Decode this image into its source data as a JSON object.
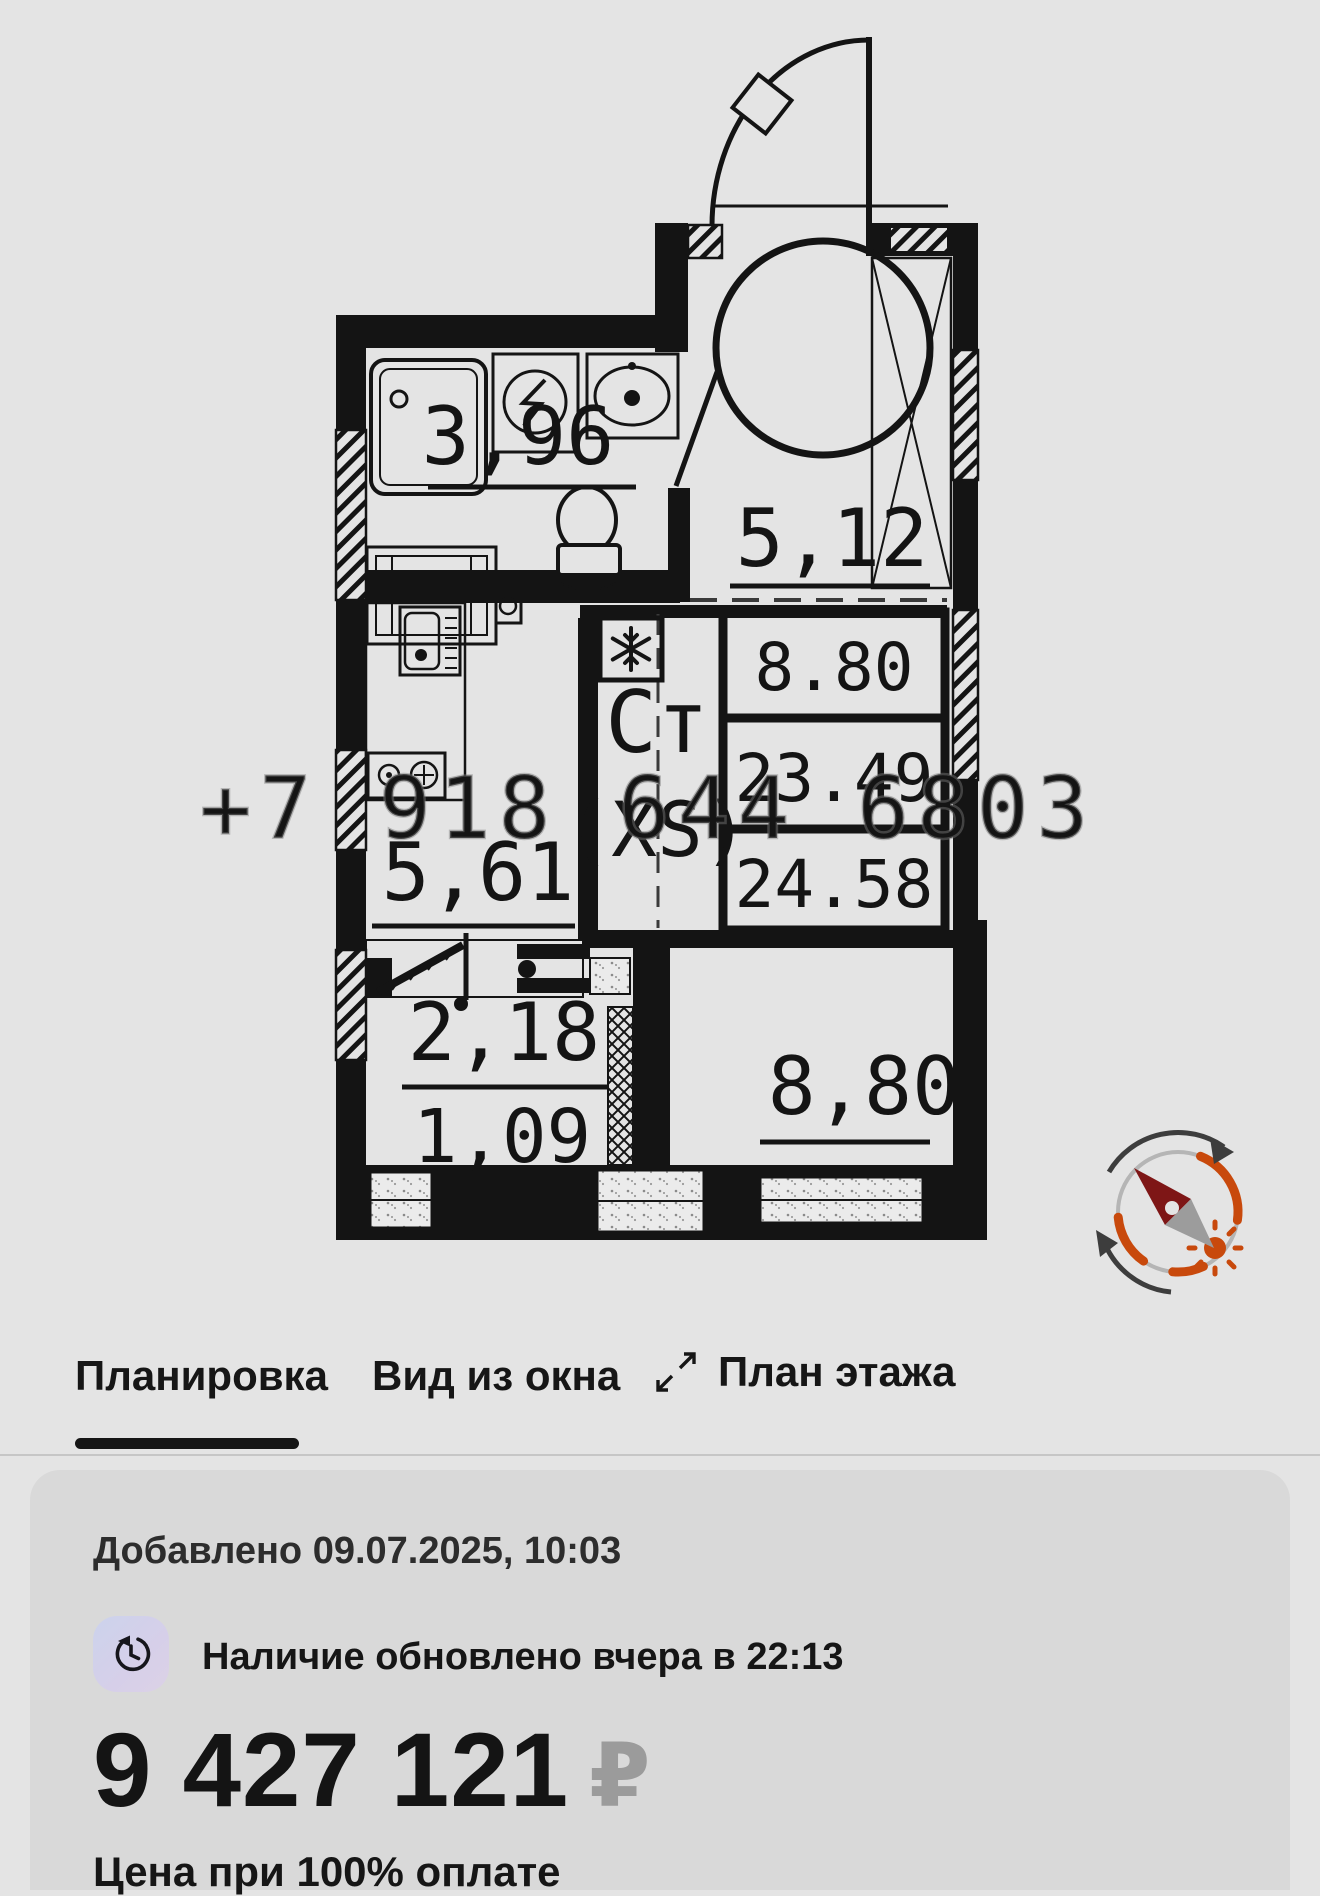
{
  "watermark": "+7 918 644 6803",
  "plan": {
    "rooms": {
      "bathroom": "3,96",
      "hallway": "5,12",
      "kitchen": "5,61",
      "corridor": "2,18",
      "closet": "1,09",
      "bedroom": "8,80"
    },
    "area_table": {
      "rows": [
        "8.80",
        "23.49",
        "24.58"
      ]
    },
    "unit_type": "Ст",
    "unit_size": "(XS)"
  },
  "tabs": {
    "items": [
      {
        "label": "Планировка",
        "active": true
      },
      {
        "label": "Вид из окна",
        "active": false
      },
      {
        "label": "План этажа",
        "active": false
      }
    ]
  },
  "card": {
    "added_text": "Добавлено 09.07.2025, 10:03",
    "availability_text": "Наличие обновлено вчера в 22:13",
    "price": "9 427 121",
    "currency": "₽",
    "price_note": "Цена при 100% оплате"
  },
  "colors": {
    "wall": "#141414",
    "accent_orange": "#c8490c",
    "needle_red": "#7e1616",
    "badge_bg": "#d2d2ea"
  }
}
